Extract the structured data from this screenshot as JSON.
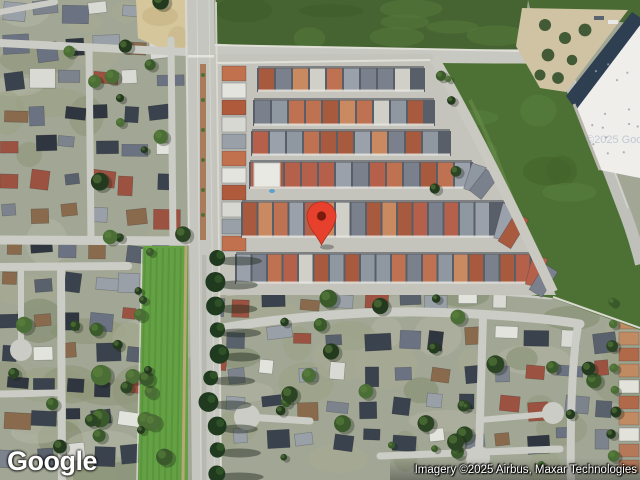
{
  "page": {
    "type": "map-embed",
    "view_mode": "satellite"
  },
  "branding": {
    "logo_text": "Google"
  },
  "attribution": {
    "text": "Imagery ©2025 Airbus, Maxar Technologies"
  },
  "watermark": {
    "text": "©2025 Google"
  },
  "marker": {
    "label": "selected-location-pin",
    "color": "#E7402D",
    "inner_color": "#7A1B0E",
    "outline_color": "#A8321E",
    "tip_x": 321.5,
    "tip_y": 245
  }
}
